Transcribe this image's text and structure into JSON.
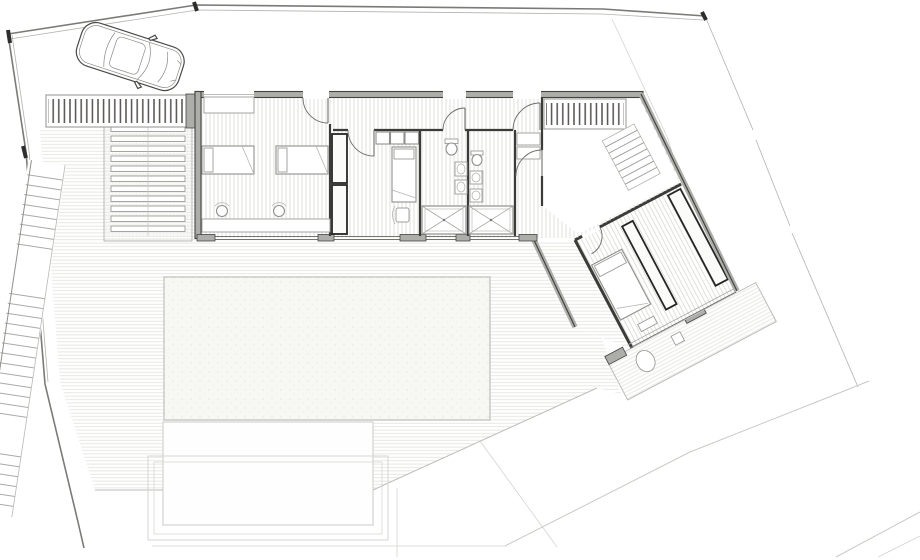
{
  "title": "Site and ground-floor architectural plan",
  "colors": {
    "background": "#ffffff",
    "boundary": "#7a7a77",
    "wall_dark": "#3b3b38",
    "wall_gray": "#adadaa",
    "floor_hatch": "#dcdcd7",
    "deck_hatch": "#e2e2de",
    "furniture": "#8f8f8c",
    "wardrobe": "#262624",
    "pool_fill": "#f7f7f4",
    "pool_border": "#c2c2be",
    "lawn_fill": "#fefefe",
    "slat": "#55504f",
    "contour": "#c9c9c5"
  },
  "site": {
    "boundary": "irregular property boundary with corner ticks",
    "car": "parked car shown in plan view, angled toward house",
    "garden_stairs": {
      "description": "long exterior stair along west boundary",
      "landings": 2
    },
    "pergola_strips": [
      "slatted canopy west of house",
      "slatted canopy over entry court"
    ],
    "louvered_ramp": {
      "slats": 11
    },
    "entry_steps": {
      "treads": 8
    },
    "deck": "hatched timber deck surrounding pool",
    "pool": {
      "shape": "rectangle"
    },
    "lawn": "lower white terrace below pool with nested retaining outlines",
    "contour_lines": 4
  },
  "rooms": [
    {
      "name": "bedroom-1",
      "furniture": [
        "single-bed",
        "single-bed",
        "desk",
        "stool",
        "stool",
        "window-shelf"
      ]
    },
    {
      "name": "hallway",
      "doors": 4
    },
    {
      "name": "bedroom-2",
      "furniture": [
        "bed",
        "tall-wardrobe",
        "tall-wardrobe",
        "overhead-cabinets",
        "chair"
      ]
    },
    {
      "name": "bathroom-1",
      "fixtures": [
        "toilet",
        "washbasin",
        "washbasin",
        "shower"
      ]
    },
    {
      "name": "bathroom-2",
      "fixtures": [
        "toilet",
        "washbasin",
        "washbasin",
        "shower"
      ]
    },
    {
      "name": "entry-hall",
      "doors": 2
    },
    {
      "name": "entry-courtyard",
      "features": [
        "slatted-canopy",
        "steps"
      ]
    },
    {
      "name": "master-bedroom",
      "furniture": [
        "double-bed",
        "wardrobe-wall",
        "wardrobe-partition",
        "bench"
      ]
    },
    {
      "name": "master-terrace",
      "fixtures": [
        "bathtub",
        "side-table"
      ]
    }
  ]
}
